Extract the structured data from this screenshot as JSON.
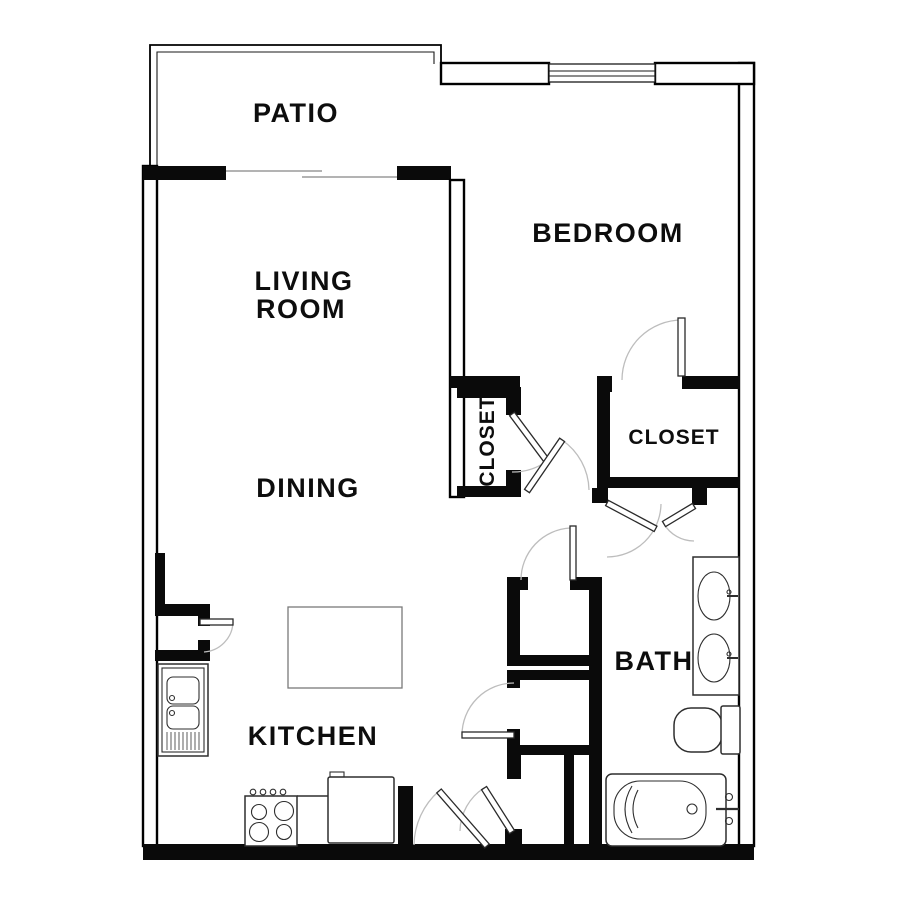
{
  "floorplan": {
    "background": "#ffffff",
    "wall_color": "#000000",
    "door_arc_color": "#bdbdbd",
    "labels": {
      "patio": "PATIO",
      "bedroom": "BEDROOM",
      "living_line1": "LIVING",
      "living_line2": "ROOM",
      "dining": "DINING",
      "closet_hall": "CLOSET",
      "closet_bedroom": "CLOSET",
      "bath": "BATH",
      "kitchen": "KITCHEN"
    },
    "fixtures": {
      "patio_door": "sliding-glass-door",
      "bedroom_window": "window",
      "kitchen": [
        "double-basin-sink",
        "range-stove",
        "refrigerator",
        "island-table"
      ],
      "bath": [
        "vanity-sink",
        "vanity-sink",
        "toilet",
        "bathtub"
      ]
    }
  }
}
